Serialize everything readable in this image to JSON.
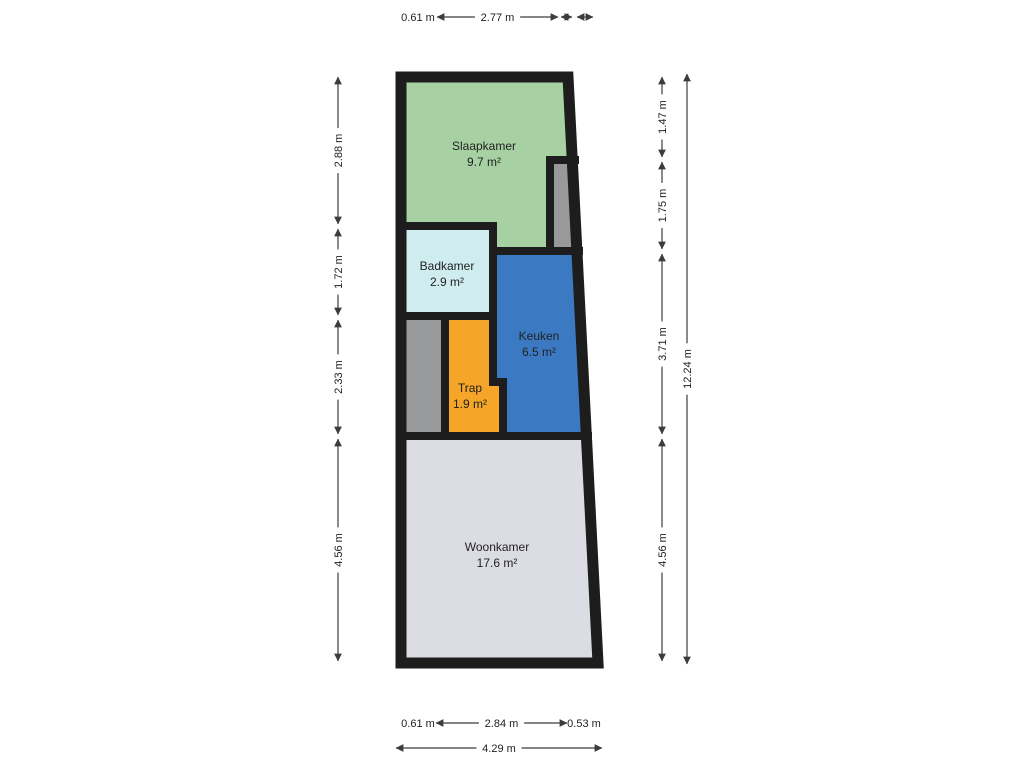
{
  "floorplan": {
    "wall_color": "#1d1d1d",
    "line_color": "#3c3c3c",
    "text_color": "#1e1e1e",
    "background_color": "#ffffff",
    "outer_points": "401,77 568,77 598,663 401,663",
    "rooms": [
      {
        "id": "slaapkamer",
        "name": "Slaapkamer",
        "area": "9.7 m²",
        "color": "#a7d1a3",
        "points": "401,77 566,77 571,160 550,160 550,251 493,251 493,226 401,226",
        "label_x": 484,
        "label_y": 150
      },
      {
        "id": "shaft-top-right",
        "name": "",
        "area": "",
        "color": "#98999b",
        "points": "550,160 573,160 577,251 550,251",
        "label_x": 0,
        "label_y": 0
      },
      {
        "id": "badkamer",
        "name": "Badkamer",
        "area": "2.9 m²",
        "color": "#cfecef",
        "points": "401,226 493,226 493,316 401,316",
        "label_x": 447,
        "label_y": 270
      },
      {
        "id": "keuken",
        "name": "Keuken",
        "area": "6.5 m²",
        "color": "#3b7ac2",
        "points": "493,251 577,251 586,436 503,436 503,382 493,382",
        "label_x": 539,
        "label_y": 340
      },
      {
        "id": "shaft-left",
        "name": "",
        "area": "",
        "color": "#98999b",
        "points": "401,316 445,316 445,436 401,436",
        "label_x": 0,
        "label_y": 0
      },
      {
        "id": "trap",
        "name": "Trap",
        "area": "1.9 m²",
        "color": "#f5a528",
        "points": "445,316 493,316 493,382 503,382 503,436 445,436",
        "label_x": 470,
        "label_y": 392
      },
      {
        "id": "woonkamer",
        "name": "Woonkamer",
        "area": "17.6 m²",
        "color": "#dcdde4",
        "points": "401,436 586,436 598,663 401,663",
        "label_x": 497,
        "label_y": 551
      }
    ],
    "walls": [
      {
        "x1": 401,
        "y1": 226,
        "x2": 493,
        "y2": 226
      },
      {
        "x1": 493,
        "y1": 226,
        "x2": 493,
        "y2": 382
      },
      {
        "x1": 493,
        "y1": 382,
        "x2": 503,
        "y2": 382
      },
      {
        "x1": 503,
        "y1": 382,
        "x2": 503,
        "y2": 436
      },
      {
        "x1": 493,
        "y1": 251,
        "x2": 579,
        "y2": 251
      },
      {
        "x1": 550,
        "y1": 160,
        "x2": 550,
        "y2": 251
      },
      {
        "x1": 550,
        "y1": 160,
        "x2": 575,
        "y2": 160
      },
      {
        "x1": 401,
        "y1": 316,
        "x2": 493,
        "y2": 316
      },
      {
        "x1": 445,
        "y1": 316,
        "x2": 445,
        "y2": 436
      },
      {
        "x1": 401,
        "y1": 436,
        "x2": 588,
        "y2": 436
      }
    ],
    "dimensions": [
      {
        "label": "0.61 m",
        "x": 418,
        "y": 21,
        "text_only": true
      },
      {
        "label": "2.77 m",
        "x1": 437,
        "y1": 17,
        "x2": 558,
        "y2": 17,
        "arrows": true
      },
      {
        "label": "",
        "x1": 561,
        "y1": 17,
        "x2": 572,
        "y2": 17,
        "arrows": true
      },
      {
        "label": "",
        "x1": 577,
        "y1": 17,
        "x2": 593,
        "y2": 17,
        "arrows": true
      },
      {
        "label": "2.88 m",
        "x1": 338,
        "y1": 77,
        "x2": 338,
        "y2": 224,
        "arrows": true
      },
      {
        "label": "1.72 m",
        "x1": 338,
        "y1": 229,
        "x2": 338,
        "y2": 315,
        "arrows": true
      },
      {
        "label": "2.33 m",
        "x1": 338,
        "y1": 320,
        "x2": 338,
        "y2": 434,
        "arrows": true
      },
      {
        "label": "4.56 m",
        "x1": 338,
        "y1": 439,
        "x2": 338,
        "y2": 661,
        "arrows": true
      },
      {
        "label": "1.47 m",
        "x1": 662,
        "y1": 77,
        "x2": 662,
        "y2": 157,
        "arrows": true
      },
      {
        "label": "1.75 m",
        "x1": 662,
        "y1": 162,
        "x2": 662,
        "y2": 249,
        "arrows": true
      },
      {
        "label": "3.71 m",
        "x1": 662,
        "y1": 254,
        "x2": 662,
        "y2": 434,
        "arrows": true
      },
      {
        "label": "4.56 m",
        "x1": 662,
        "y1": 439,
        "x2": 662,
        "y2": 661,
        "arrows": true
      },
      {
        "label": "12.24 m",
        "x1": 687,
        "y1": 74,
        "x2": 687,
        "y2": 664,
        "arrows": true
      },
      {
        "label": "0.61 m",
        "x": 418,
        "y": 727,
        "text_only": true
      },
      {
        "label": "2.84 m",
        "x1": 436,
        "y1": 723,
        "x2": 567,
        "y2": 723,
        "arrows": true
      },
      {
        "label": "0.53 m",
        "x": 584,
        "y": 727,
        "text_only": true
      },
      {
        "label": "4.29 m",
        "x1": 396,
        "y1": 748,
        "x2": 602,
        "y2": 748,
        "arrows": true
      }
    ]
  }
}
